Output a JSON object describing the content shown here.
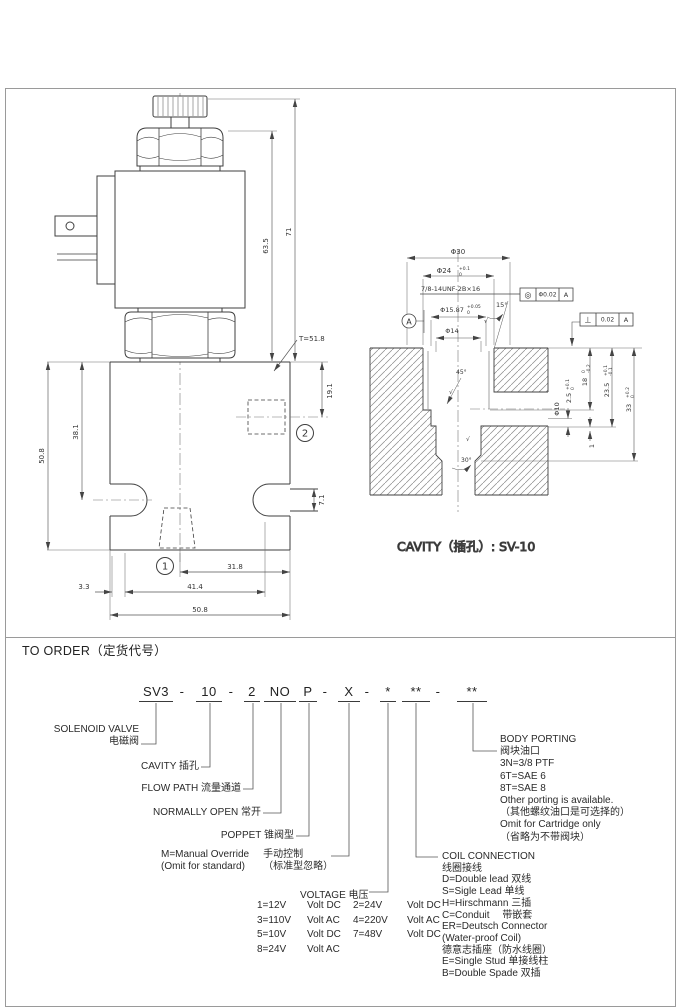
{
  "valve": {
    "dim_63_5": "63.5",
    "dim_71": "71",
    "note_t": "T=51.8",
    "dim_19_1": "19.1",
    "dim_50_8_left": "50.8",
    "dim_38_1": "38.1",
    "dim_7_1": "7.1",
    "dim_31_8": "31.8",
    "dim_3_3": "3.3",
    "dim_41_4": "41.4",
    "dim_50_8_bottom": "50.8",
    "port1": "1",
    "port2": "2"
  },
  "cavity": {
    "caption": "CAVITY（插孔）: SV-10",
    "d30": "Φ30",
    "d24": "Φ24",
    "d24_sup": "+0.1",
    "d24_sub": "0",
    "thread": "7/8-14UNF-2B×16",
    "d15_87": "Φ15.87",
    "d15_87_sup": "+0.05",
    "d15_87_sub": "0",
    "d14": "Φ14",
    "d10": "Φ10",
    "ang15": "15°",
    "ang45": "45°",
    "ang30": "30°",
    "dep2_5": "2.5",
    "dep2_5_sup": "+0.1",
    "dep2_5_sub": "0",
    "dep18": "18",
    "dep18_sup": "0",
    "dep18_sub": "-0.2",
    "dep23_5": "23.5",
    "dep23_5_sup": "+0.1",
    "dep23_5_sub": "-0.1",
    "dep33": "33",
    "dep33_sup": "+0.2",
    "dep33_sub": "0",
    "dim1": "1",
    "datum": "A",
    "gdt_conc_sym": "◎",
    "gdt_conc_val": "Φ0.02",
    "gdt_conc_datum": "A",
    "gdt_perp_sym": "⊥",
    "gdt_perp_val": "0.02",
    "gdt_perp_datum": "A",
    "rough": "√"
  },
  "order": {
    "title": "TO ORDER（定货代号）",
    "code": [
      "SV3",
      "-",
      "10",
      "-",
      "2",
      "NO",
      "P",
      "-",
      "X",
      "-",
      "*",
      "**",
      "-",
      "**"
    ],
    "solenoid_en": "SOLENOID VALVE",
    "solenoid_zh": "电磁阀",
    "cavity_label": "CAVITY  插孔",
    "flow_label": "FLOW PATH  流量通道",
    "no_label": "NORMALLY OPEN  常开",
    "poppet_label": "POPPET  锥阀型",
    "manual_en1": "M=Manual Override",
    "manual_en2": "(Omit for standard)",
    "manual_zh1": "手动控制",
    "manual_zh2": "（标准型忽略）",
    "voltage_heading": "VOLTAGE  电压",
    "voltage_rows": [
      {
        "c1": "1=12V",
        "u1": "Volt DC",
        "c2": "2=24V",
        "u2": "Volt DC"
      },
      {
        "c1": "3=110V",
        "u1": "Volt AC",
        "c2": "4=220V",
        "u2": "Volt AC"
      },
      {
        "c1": "5=10V",
        "u1": "Volt DC",
        "c2": "7=48V",
        "u2": "Volt DC"
      },
      {
        "c1": "8=24V",
        "u1": "Volt AC",
        "c2": "",
        "u2": ""
      }
    ],
    "coil_heading_en": "COIL CONNECTION",
    "coil_heading_zh": "线圈接线",
    "coil_items": [
      "D=Double lead 双线",
      "S=Sigle Lead  单线",
      "H=Hirschmann  三插",
      "C=Conduit　 带嵌套",
      "ER=Deutsch Connector",
      "(Water-proof Coil)",
      "德意志插座（防水线圈）",
      "E=Single Stud  单接线柱",
      "B=Double Spade  双插"
    ],
    "porting_heading_en": "BODY PORTING",
    "porting_heading_zh": "阀块油口",
    "porting_items": [
      "3N=3/8 PTF",
      "6T=SAE 6",
      "8T=SAE 8",
      "Other porting is available.",
      "（其他螺纹油口是可选择的）",
      "Omit for Cartridge only",
      "（省略为不带阀块）"
    ]
  }
}
